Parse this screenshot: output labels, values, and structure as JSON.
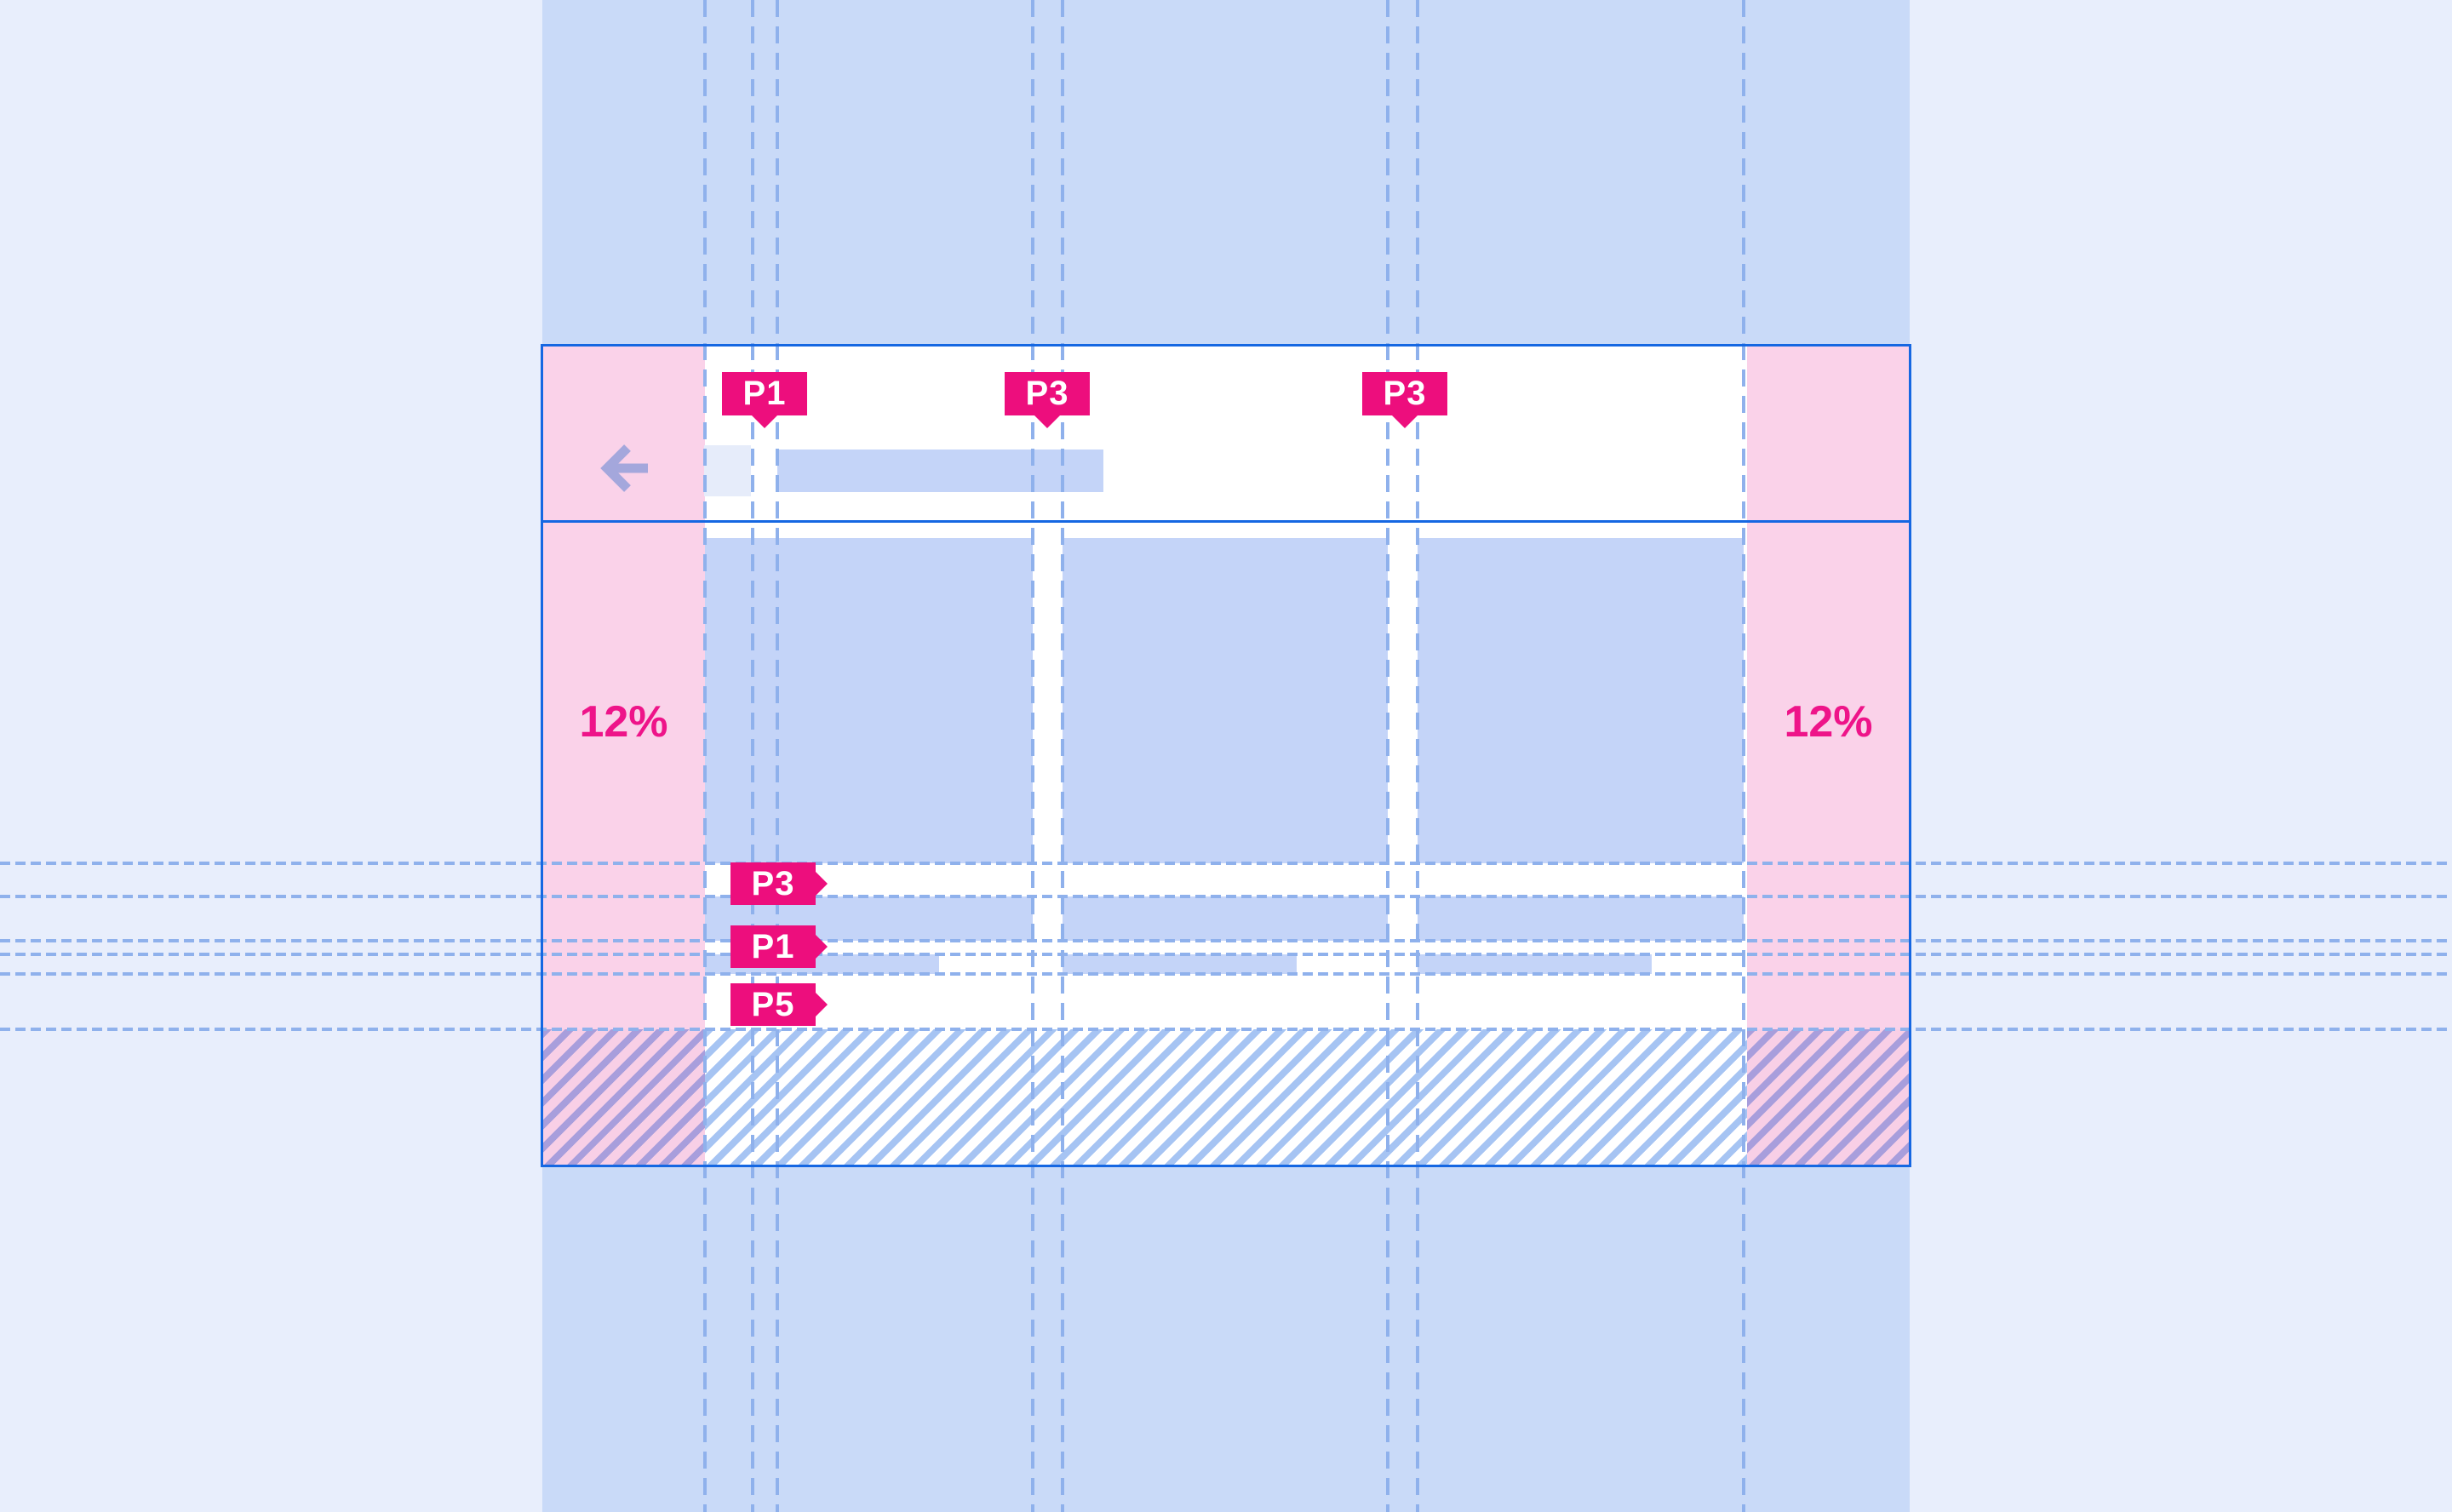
{
  "annotations": {
    "margin_left_label": "12%",
    "margin_right_label": "12%",
    "top_padding_chips": [
      {
        "label": "P1"
      },
      {
        "label": "P3"
      },
      {
        "label": "P3"
      }
    ],
    "row_padding_chips": [
      {
        "label": "P3"
      },
      {
        "label": "P1"
      },
      {
        "label": "P5"
      }
    ]
  },
  "icons": {
    "back": "arrow-back-icon"
  },
  "colors": {
    "bg": "#e8eefc",
    "band": "#c9daf8",
    "placeholder": "#c4d4f8",
    "lightbox": "#e6ecfa",
    "pink": "#fad2e9",
    "chip": "#ed0e7d",
    "pink_text": "#ee1489",
    "border": "#1567e2",
    "dash": "#8fb1ec",
    "arrow": "#a4a7dc",
    "hatch_blue": "#a6c4f3",
    "hatch_violet": "#a89edc",
    "hatch_pink": "#f8cfe6"
  }
}
